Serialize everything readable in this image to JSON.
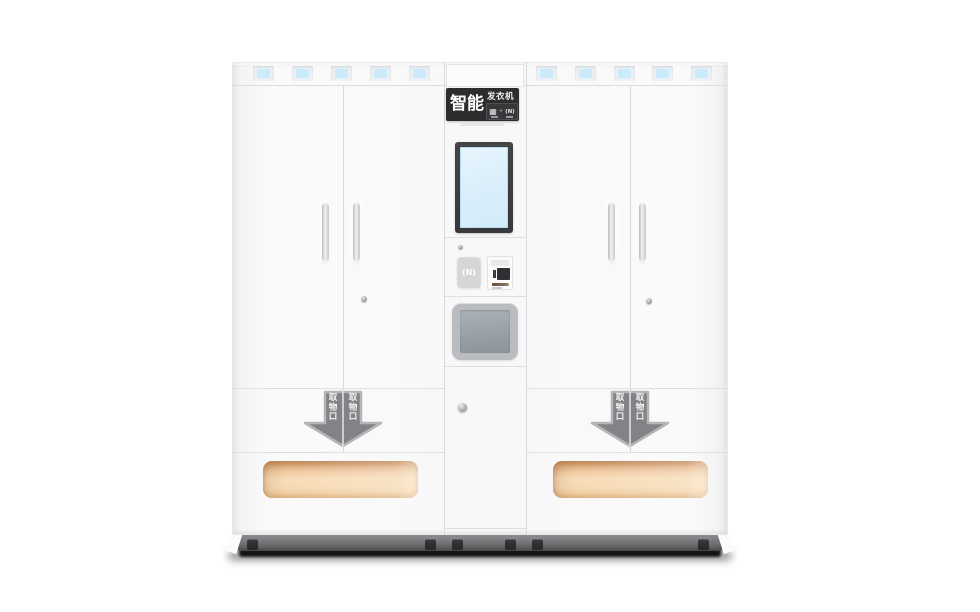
{
  "scene": {
    "background_color": "#ffffff",
    "subject": "smart clothing dispenser vending machine, front view product render"
  },
  "signboard": {
    "title_main": "智能",
    "title_sub": "发衣机",
    "qr_icon_glyph": "▦",
    "separator_glyph": "+",
    "contactless_icon_glyph": "(N)"
  },
  "center_column": {
    "nfc_pad_glyph": "(N)"
  },
  "pickup": {
    "arrow_label": "取物口"
  },
  "colors": {
    "cabinet_body": "#f8f8f9",
    "sign_background": "#2d2d30",
    "screen_blue": "#d9eefb",
    "indicator_blue": "#cbeafa",
    "hatch_gray": "#99a0a8",
    "arrow_gray": "#818386",
    "slot_glow_orange": "#f7d9b4",
    "plinth_gray": "#6e7072"
  }
}
